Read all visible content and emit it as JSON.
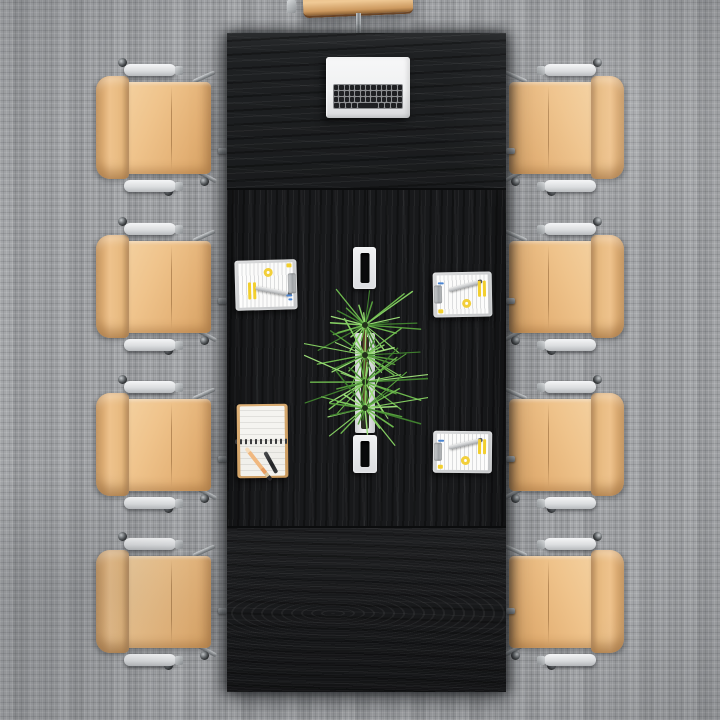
{
  "scene": {
    "title": "Conference room — top view",
    "description": "Top-down 3D render of a black wood conference table on gray woven carpet, surrounded by eight tan leather office chairs with chrome bases, holding a white laptop, three clipboards with annotated documents, a spiral notebook with pencil and pen, two white cable trays and a spiky green plant centerpiece."
  },
  "objects": {
    "carpet": {
      "label": "gray woven carpet floor"
    },
    "table": {
      "label": "black oak conference table",
      "sections": 3
    },
    "laptop": {
      "label": "open white laptop with black keys"
    },
    "chairs": {
      "label": "tan leather office chair",
      "count_left": 4,
      "count_right": 4,
      "count_top_partial": 1,
      "frame": "chrome base with white armrests"
    },
    "clipboards": [
      {
        "label": "clipboard with document, yellow highlights, donut chart and pen — left side"
      },
      {
        "label": "clipboard with document, yellow highlights, donut chart and pen — right top"
      },
      {
        "label": "clipboard with document, yellow highlights, donut chart and pen — right bottom"
      }
    ],
    "notebook": {
      "label": "open spiral notebook",
      "accessories": [
        "orange pencil",
        "black pen"
      ]
    },
    "trays": [
      {
        "label": "white cable tray with slot — upper"
      },
      {
        "label": "white cable tray with slot — lower"
      }
    ],
    "planter": {
      "label": "white center planter strip"
    },
    "plant": {
      "label": "spiky green plant centerpiece",
      "tufts": 4
    }
  },
  "palette": {
    "carpet": "#9b9da0",
    "table": "#17181a",
    "leather": "#eec28c",
    "leather_shadow": "#c9985f",
    "chrome": "#b6babd",
    "white": "#f2f3f4",
    "paper": "#fbfbfa",
    "highlight_yellow": "#f2cf2e",
    "accent_blue": "#4b85d1",
    "plant_greens": [
      "#3f7f2e",
      "#569e3d",
      "#6db84e",
      "#83cc61",
      "#9adb77"
    ],
    "stem_brown": "#5d4127",
    "pencil_orange": "#f0b87f"
  }
}
